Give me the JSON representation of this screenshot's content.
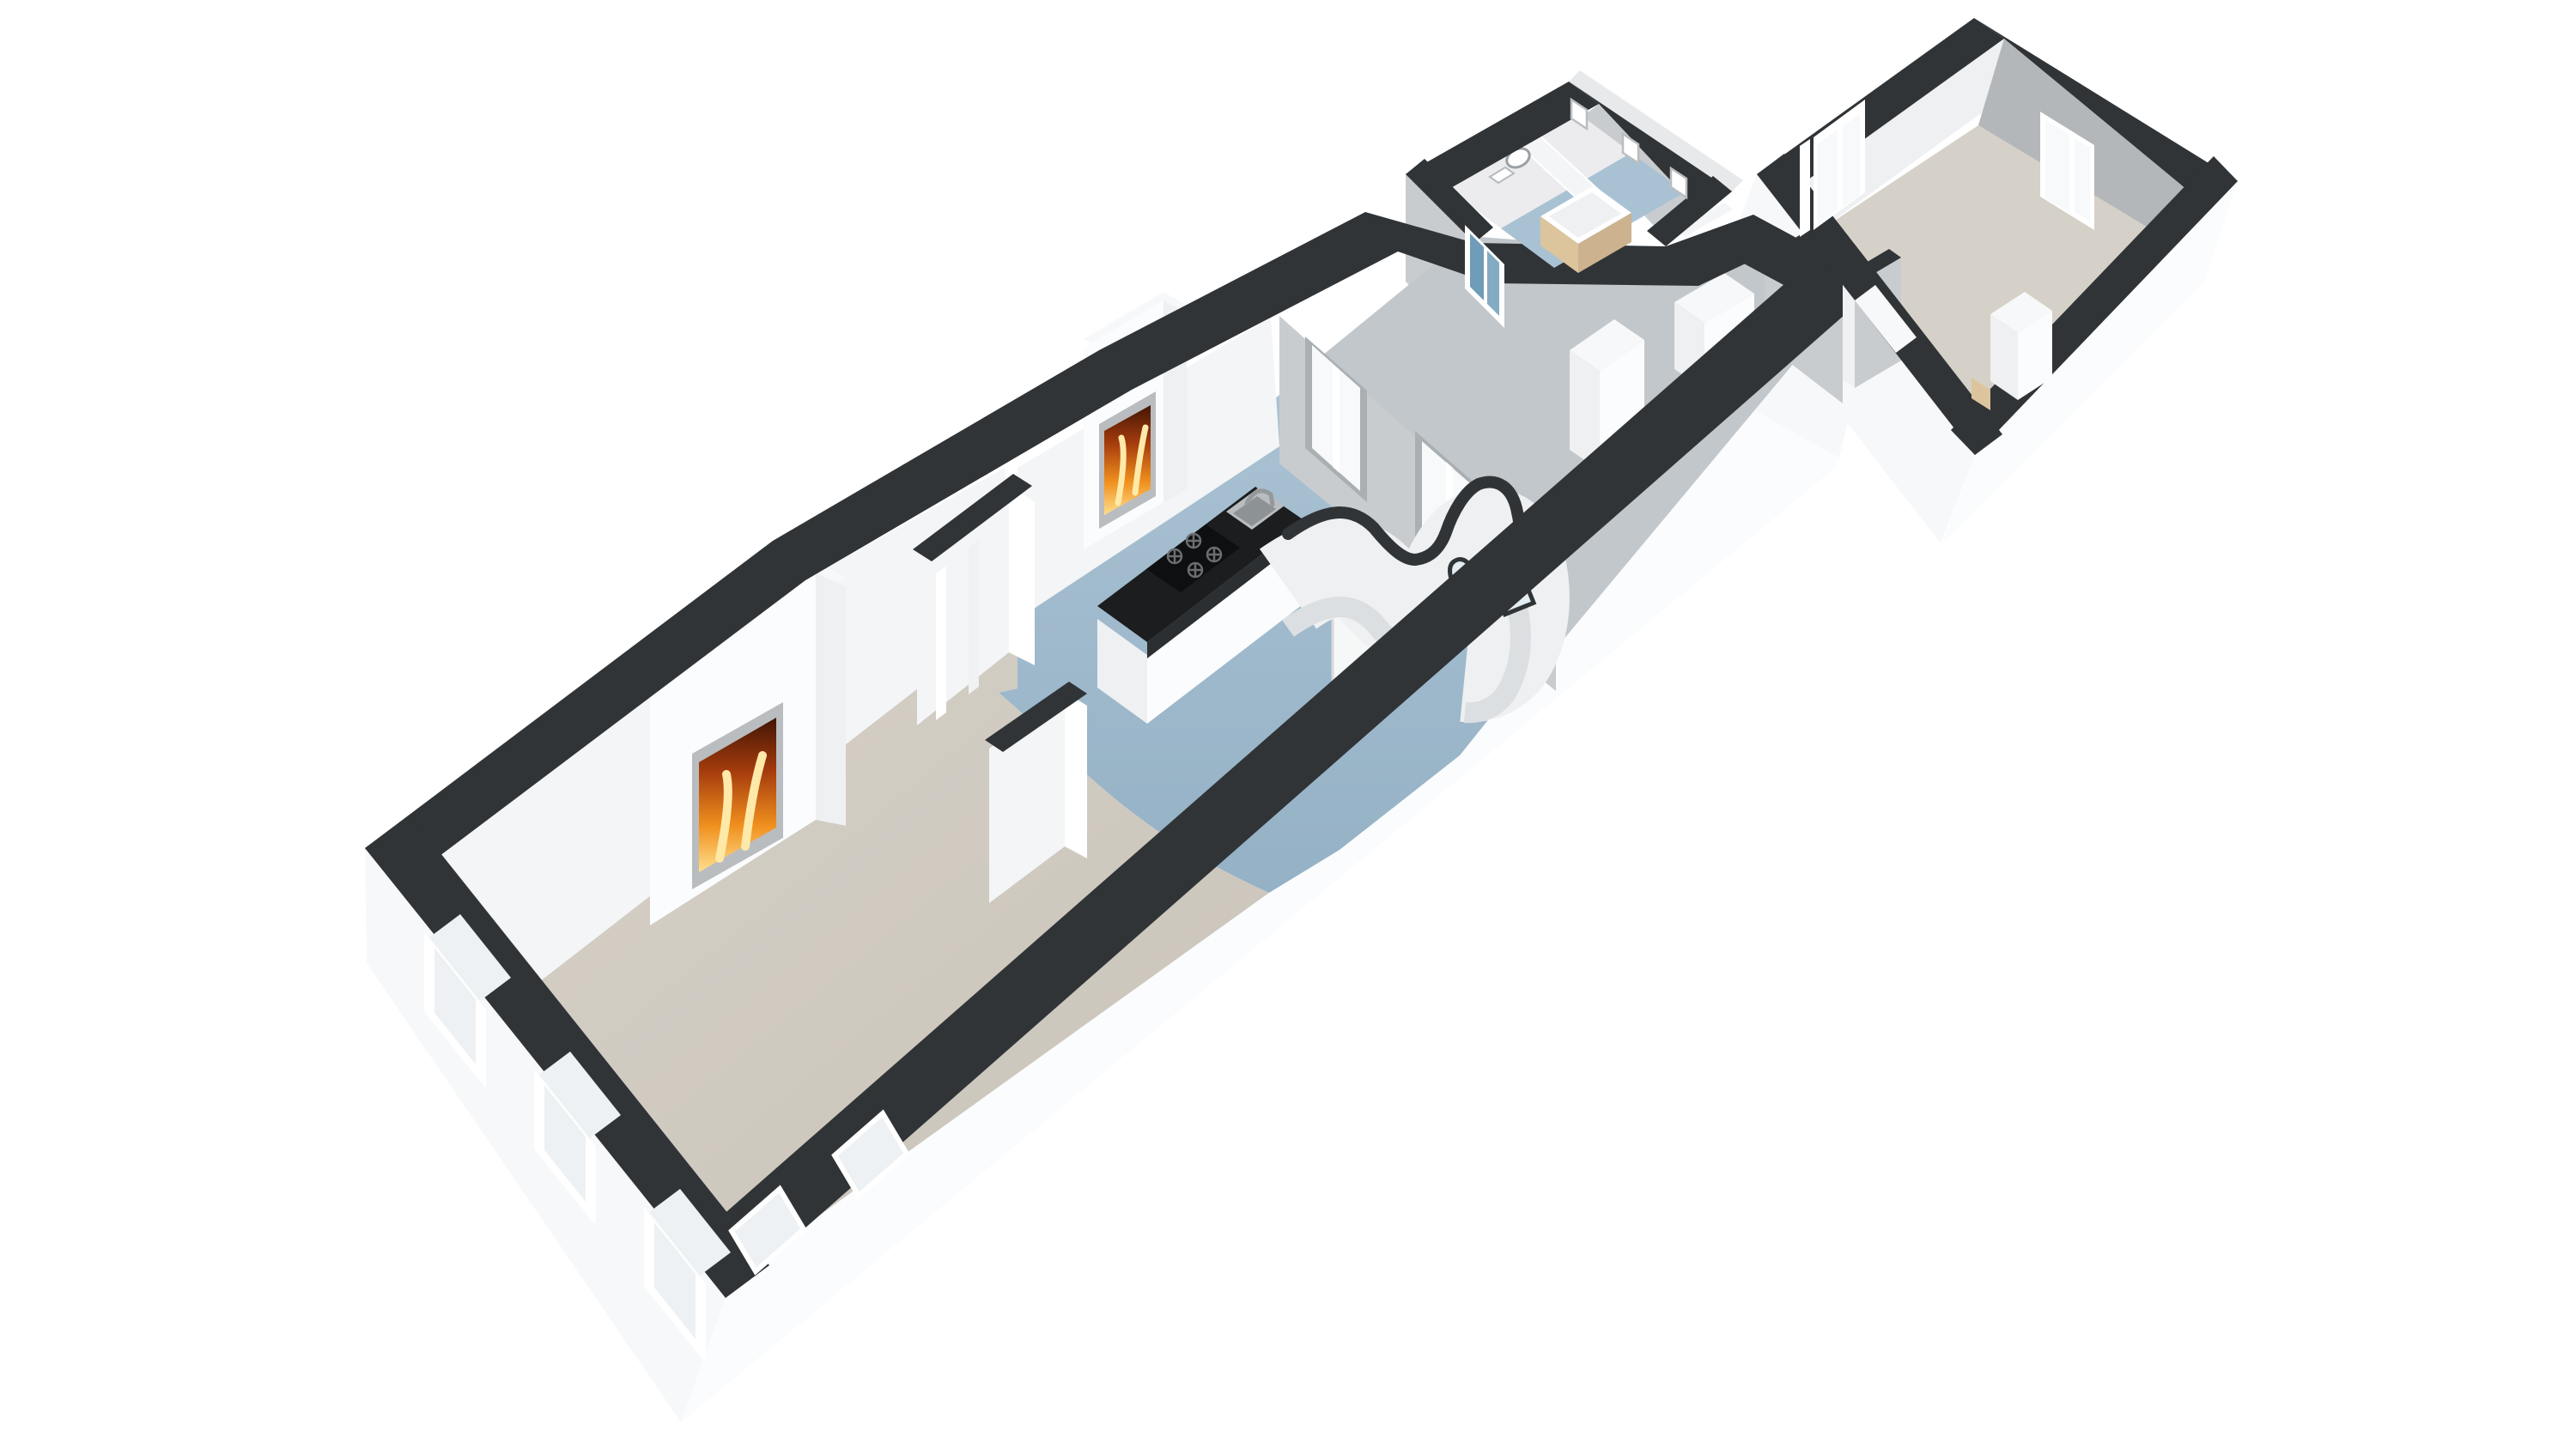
{
  "scene": {
    "type": "3d-floorplan-render",
    "rooms": [
      "living-room",
      "kitchen",
      "hallway",
      "bathroom-annex",
      "wc",
      "bedroom"
    ],
    "fireplace_count": 2,
    "facade_window_count": 3
  },
  "colors": {
    "bg": "#ffffff",
    "wall_top": "#303437",
    "wall_top_dark": "#26292c",
    "wall_white": "#fbfcfd",
    "wall_white_shade": "#eef0f1",
    "skirt_white": "#f7f8f9",
    "skirt_shade": "#e7e9eb",
    "wall_gray": "#c9cccf",
    "wall_gray_dark": "#b4b7ba",
    "wall_inner_white": "#f4f5f6",
    "panel_white": "#f0f1f2",
    "floor_beige": "#d6d1c8",
    "floor_beige_dark": "#c9c3b9",
    "floor_blue": "#a9c2d3",
    "floor_blue_dark": "#95b1c5",
    "floor_wc": "#ececee",
    "floor_hall": "#c2c7cb",
    "glass_white": "#f7f9fa",
    "glass_pale": "#edf1f3",
    "glass_blue": "#6f9cb8",
    "glass_blue_light": "#84abc4",
    "frame_white": "#ffffff",
    "frame_gray": "#a9afb2",
    "counter_black": "#1b1d1f",
    "counter_side": "#2c2f31",
    "steel": "#b9bdbf",
    "steel_dark": "#8d9294",
    "wood_tan": "#ccb28e",
    "wood_light": "#dcc49c",
    "fire_yellow": "#ffdf8c",
    "fire_orange": "#f0901e",
    "fire_red": "#a63c0d",
    "fire_dark": "#421505",
    "door_white": "#f6f7f7",
    "arch_fill": "#e4edf2"
  }
}
